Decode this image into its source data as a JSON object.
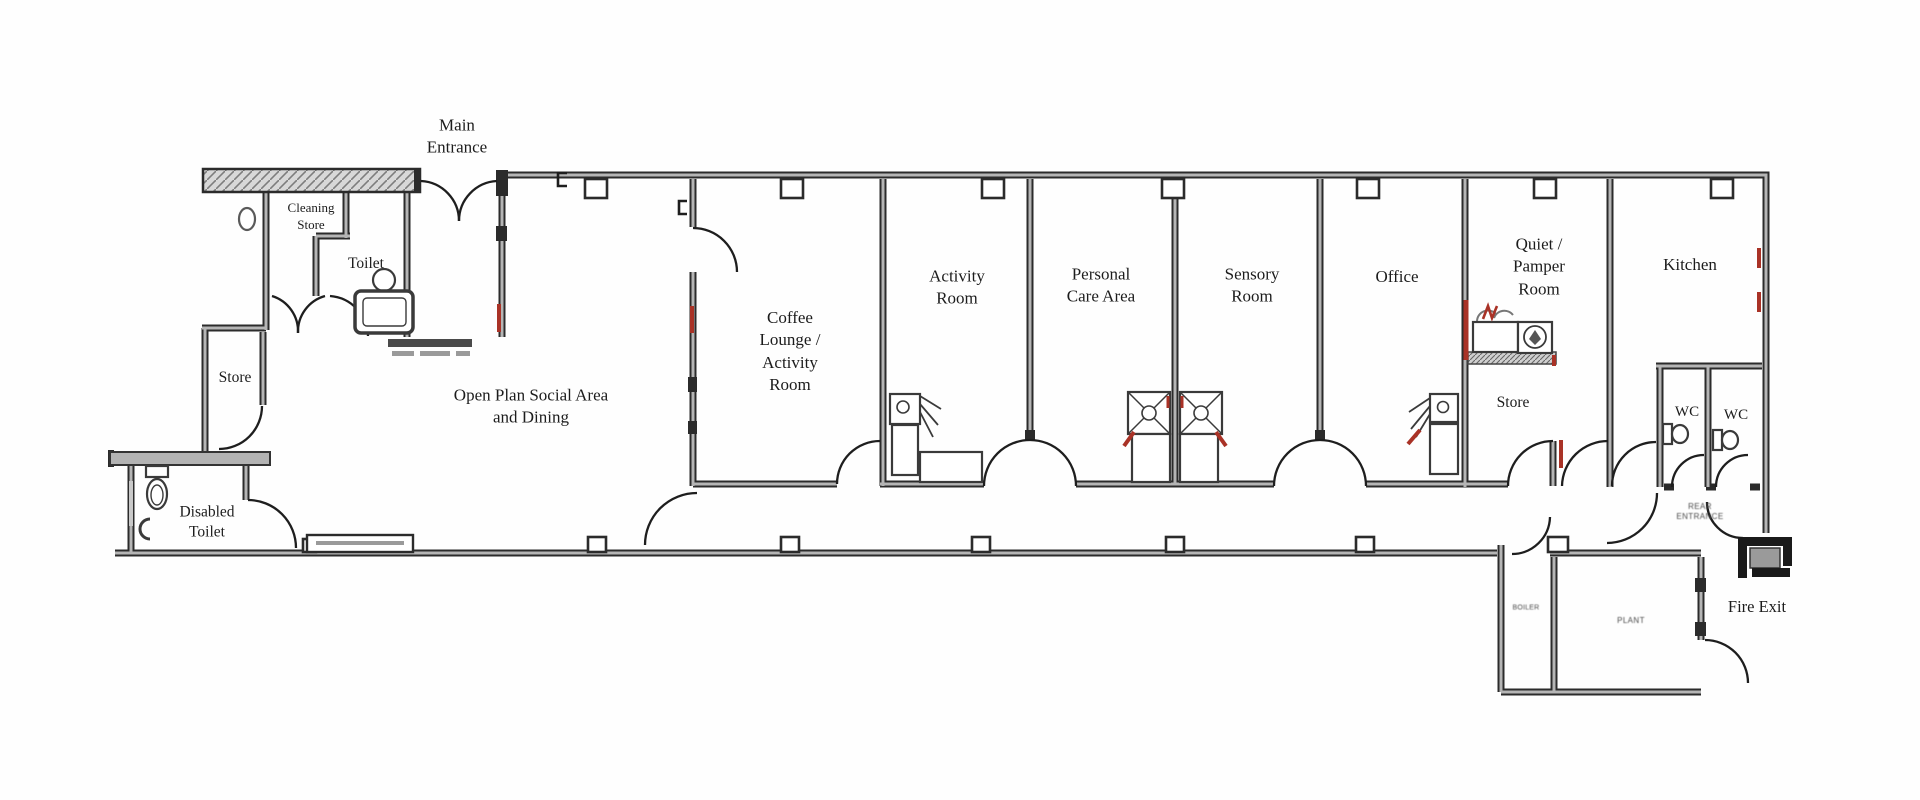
{
  "document": {
    "type": "building floor plan",
    "colors": {
      "background": "#ffffff",
      "wall_edge": "#2b2b2b",
      "wall_core": "#b5b5b5",
      "hatch_fill": "#d8d8d8",
      "accent_red": "#a93226",
      "label_text": "#1c1c1c"
    },
    "fixtures": [
      "toilet",
      "disabled-toilet",
      "cleaning-sink",
      "activity-sink",
      "care-double-sink",
      "office-sink",
      "pamper-bed",
      "pamper-basin",
      "wc-toilet",
      "radiator",
      "counter",
      "window-bay"
    ]
  },
  "labels": {
    "main_entrance": "Main\nEntrance",
    "cleaning_store": "Cleaning\nStore",
    "toilet": "Toilet",
    "store_left": "Store",
    "disabled_toilet": "Disabled\nToilet",
    "open_plan": "Open Plan Social Area\nand Dining",
    "coffee_lounge": "Coffee\nLounge /\nActivity\nRoom",
    "activity_room": "Activity\nRoom",
    "personal_care": "Personal\nCare Area",
    "sensory_room": "Sensory\nRoom",
    "office": "Office",
    "quiet_pamper": "Quiet /\nPamper\nRoom",
    "kitchen": "Kitchen",
    "store_right": "Store",
    "wc_1": "WC",
    "wc_2": "WC",
    "rear_entrance": "REAR\nENTRANCE",
    "boiler": "BOILER",
    "plant": "PLANT",
    "fire_exit": "Fire Exit"
  }
}
